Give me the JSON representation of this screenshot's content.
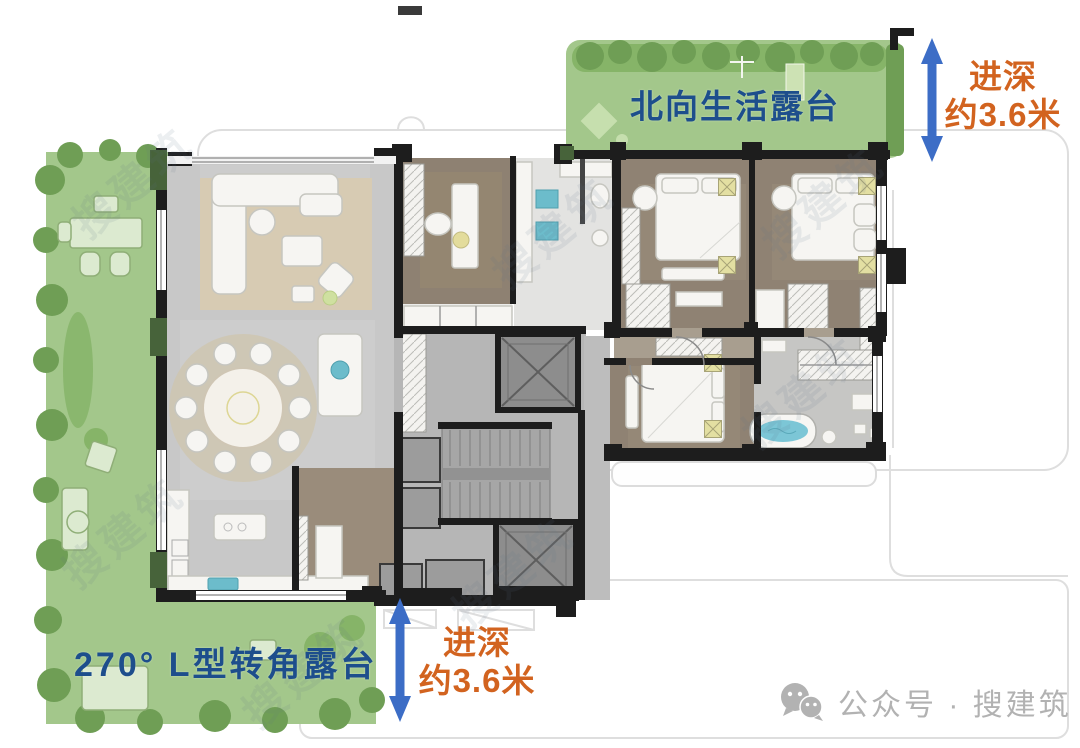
{
  "annotations": {
    "north_terrace_label": "北向生活露台",
    "corner_terrace_label": "270° L型转角露台",
    "depth_right": {
      "line1": "进深",
      "line2": "约3.6米"
    },
    "depth_bottom": {
      "line1": "进深",
      "line2": "约3.6米"
    }
  },
  "watermark": {
    "icon": "wechat-icon",
    "account_text": "公众号 · 搜建筑",
    "diagonal_text": "搜建筑"
  },
  "colors": {
    "terrace_green": "#a3c78b",
    "hedge_green": "#6f9e55",
    "label_blue": "#1d4e8c",
    "dim_orange": "#d2631f",
    "arrow_blue": "#3c6dc6",
    "wall_black": "#1d1d1d",
    "watermark_gray": "#b2b2b2"
  }
}
